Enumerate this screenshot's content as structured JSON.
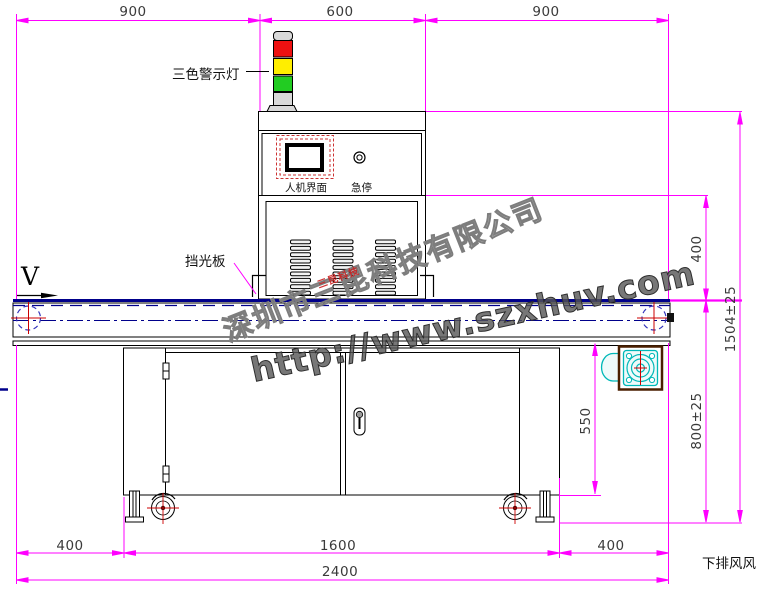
{
  "labels": {
    "warning_light": "三色警示灯",
    "hmi": "人机界面",
    "estop": "急停",
    "light_shield": "挡光板",
    "direction_v": "V",
    "bottom_exhaust": "下排风风"
  },
  "dimensions": {
    "top": [
      "900",
      "600",
      "900"
    ],
    "right": [
      "400",
      "1504±25",
      "800±25"
    ],
    "inner": [
      "550"
    ],
    "bottom": [
      "400",
      "1600",
      "400",
      "2400"
    ]
  },
  "watermark": {
    "company": "深圳市三昆科技有限公司",
    "url": "http://www.szxhuv.com",
    "stamp": "三昆科技"
  },
  "colors": {
    "dimension_magenta": "#FF00FF",
    "belt_navy": "#00008B",
    "lamp_red": "#EE1111",
    "lamp_yellow": "#FFEE00",
    "lamp_green": "#22CC22",
    "lamp_grey": "#D9D9D9",
    "fan_cyan": "#00B8B8",
    "crosshair_red": "#CC0000"
  }
}
